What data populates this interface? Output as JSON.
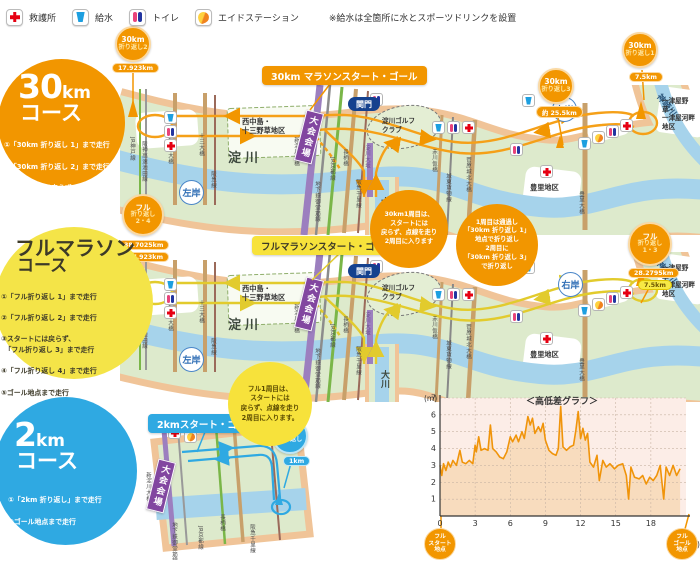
{
  "legend": {
    "first_aid": "救護所",
    "water": "給水",
    "toilet": "トイレ",
    "aid_station": "エイドステーション",
    "note": "※給水は全箇所に水とスポーツドリンクを設置"
  },
  "course30": {
    "title": "30",
    "title_unit": "km",
    "subtitle": "コース",
    "steps": [
      "①「30km 折り返し 1」まで走行",
      "②「30km 折り返し 2」まで走行",
      "③スタートには戻らず、\n　「30km 折り返し 3」まで走行",
      "④ゴール地点まで走行"
    ]
  },
  "courseFull": {
    "title": "フルマラソン",
    "subtitle": "コース",
    "steps": [
      "①「フル折り返し 1」まで走行",
      "②「フル折り返し 2」まで走行",
      "③スタートには戻らず、\n　「フル折り返し 3」まで走行",
      "④「フル折り返し 4」まで走行",
      "⑤ゴール地点まで走行"
    ]
  },
  "course2": {
    "title": "2",
    "title_unit": "km",
    "subtitle": "コース",
    "steps": [
      "①「2km 折り返し」まで走行",
      "②ゴール地点まで走行"
    ]
  },
  "map30": {
    "start_goal": "30km マラソンスタート・ゴール",
    "turn1_l1": "30km",
    "turn1_l2": "折り返し1",
    "turn1_dist": "7.5km",
    "turn2_l1": "30km",
    "turn2_l2": "折り返し2",
    "turn2_dist": "17.923km",
    "turn3_l1": "30km",
    "turn3_l2": "折り返し3",
    "turn3_dist": "約 25.5km",
    "note_lap": "30km1周目は、\nスタートには\n戻らず、点線を走り\n2周目に入ります",
    "note_turn": "1周目は通過し\n「30km 折り返し 1」\n地点で折り返し\n2周目に\n「30km 折り返し 3」\nで折り返し"
  },
  "mapFull": {
    "start_goal": "フルマラソンスタート・ゴール",
    "turn13_l1": "フル",
    "turn13_l2": "折り返し\n1・3",
    "turn13_dist1": "28.2795km",
    "turn13_dist2": "7.5km",
    "turn24_l1": "フル",
    "turn24_l2": "折り返し\n2・4",
    "turn24_dist1": "38.7025km",
    "turn24_dist2": "17.923km",
    "note_lap": "フル1周目は、\nスタートには\n戻らず、点線を走り\n2周目に入ります。"
  },
  "map2": {
    "start_goal": "2kmスタート・ゴール",
    "turn_l1": "2km",
    "turn_l2": "折り返し",
    "turn_dist": "1km"
  },
  "geo": {
    "checkpoint": "関門",
    "right_bank": "右岸",
    "left_bank": "左岸",
    "yodogawa": "淀川",
    "kanzakigawa": "神崎川",
    "okawa": "大川",
    "venue": "大会会場",
    "area_nishinakajima": "西中島・\n十三野草地区",
    "area_golf": "淀川ゴルフ\nクラブ",
    "area_toyosato": "豊里地区",
    "area_hitotsuya": "一津屋野草・\n一津屋河畔\n地区"
  },
  "bridges": {
    "jr_kobe": "JR神戸線",
    "hanshin_exp": "阪神高速池田線",
    "shin_juso": "新十三大橋",
    "juso": "十三大橋",
    "hankyu": "阪急線",
    "shin_yodogawa": "新淀川大橋",
    "midosuji": "地下鉄御堂筋線",
    "jr_kyoto": "JR京都線",
    "nagara": "長柄橋",
    "hankyu_senri": "阪急千里線",
    "yodogawa_ozeki": "淀川大堰",
    "akagawa": "赤川仮橋",
    "joto_kamotsu": "城東貨物線",
    "sugahara": "菅原城北大橋",
    "toyosato_ohashi": "豊里大橋"
  },
  "chart_data": {
    "type": "area",
    "title": "＜高低差グラフ＞",
    "ylabel": "(m)",
    "xlabel": "(km)",
    "ylim": [
      0,
      7
    ],
    "xlim": [
      0,
      21
    ],
    "yticks": [
      1,
      2,
      3,
      4,
      5,
      6,
      7
    ],
    "xticks": [
      0,
      3,
      6,
      9,
      12,
      15,
      18
    ],
    "start_label": "フル\nスタート\n地点",
    "goal_label": "フル\nゴール\n地点",
    "line_color": "#F0940A",
    "fill_color": "#F8DCBE",
    "bg_color": "#FCEDE7",
    "points": [
      [
        0,
        3.0
      ],
      [
        0.15,
        2.4
      ],
      [
        0.3,
        3.1
      ],
      [
        0.5,
        2.7
      ],
      [
        0.7,
        3.2
      ],
      [
        0.9,
        2.9
      ],
      [
        1.1,
        3.3
      ],
      [
        1.4,
        3.0
      ],
      [
        1.7,
        3.9
      ],
      [
        1.9,
        3.2
      ],
      [
        2.2,
        3.1
      ],
      [
        2.5,
        3.3
      ],
      [
        2.8,
        3.1
      ],
      [
        3.0,
        4.2
      ],
      [
        3.1,
        3.8
      ],
      [
        3.3,
        4.7
      ],
      [
        3.5,
        3.9
      ],
      [
        3.8,
        4.0
      ],
      [
        4.1,
        3.9
      ],
      [
        4.3,
        5.4
      ],
      [
        4.5,
        4.0
      ],
      [
        4.8,
        3.8
      ],
      [
        5.1,
        3.5
      ],
      [
        5.4,
        3.4
      ],
      [
        5.7,
        3.8
      ],
      [
        6.0,
        4.7
      ],
      [
        6.2,
        4.4
      ],
      [
        6.5,
        4.8
      ],
      [
        6.7,
        4.4
      ],
      [
        7.0,
        5.0
      ],
      [
        7.2,
        4.6
      ],
      [
        7.5,
        5.9
      ],
      [
        7.7,
        5.4
      ],
      [
        7.9,
        5.8
      ],
      [
        8.1,
        4.9
      ],
      [
        8.4,
        5.3
      ],
      [
        8.6,
        5.0
      ],
      [
        8.8,
        5.5
      ],
      [
        9.0,
        4.5
      ],
      [
        9.3,
        3.9
      ],
      [
        9.6,
        3.7
      ],
      [
        9.9,
        3.6
      ],
      [
        10.1,
        4.0
      ],
      [
        10.3,
        6.5
      ],
      [
        10.5,
        4.1
      ],
      [
        10.8,
        3.9
      ],
      [
        11.1,
        4.1
      ],
      [
        11.4,
        4.2
      ],
      [
        11.6,
        5.1
      ],
      [
        11.8,
        6.2
      ],
      [
        12.0,
        4.6
      ],
      [
        12.2,
        5.2
      ],
      [
        12.4,
        4.5
      ],
      [
        12.6,
        4.9
      ],
      [
        12.8,
        3.2
      ],
      [
        13.1,
        2.9
      ],
      [
        13.4,
        3.6
      ],
      [
        13.6,
        2.1
      ],
      [
        13.9,
        3.3
      ],
      [
        14.2,
        2.9
      ],
      [
        14.5,
        3.1
      ],
      [
        14.9,
        2.8
      ],
      [
        15.2,
        3.0
      ],
      [
        15.6,
        3.1
      ],
      [
        15.9,
        2.4
      ],
      [
        16.1,
        1.0
      ],
      [
        16.3,
        2.9
      ],
      [
        16.6,
        2.3
      ],
      [
        17.0,
        2.2
      ],
      [
        17.3,
        2.4
      ],
      [
        17.6,
        1.9
      ],
      [
        17.9,
        2.3
      ],
      [
        18.2,
        2.1
      ],
      [
        18.5,
        2.4
      ],
      [
        18.8,
        3.0
      ],
      [
        19.1,
        1.0
      ],
      [
        19.3,
        2.9
      ],
      [
        19.6,
        2.4
      ],
      [
        19.9,
        3.0
      ],
      [
        20.2,
        2.4
      ],
      [
        20.5,
        2.8
      ]
    ]
  }
}
